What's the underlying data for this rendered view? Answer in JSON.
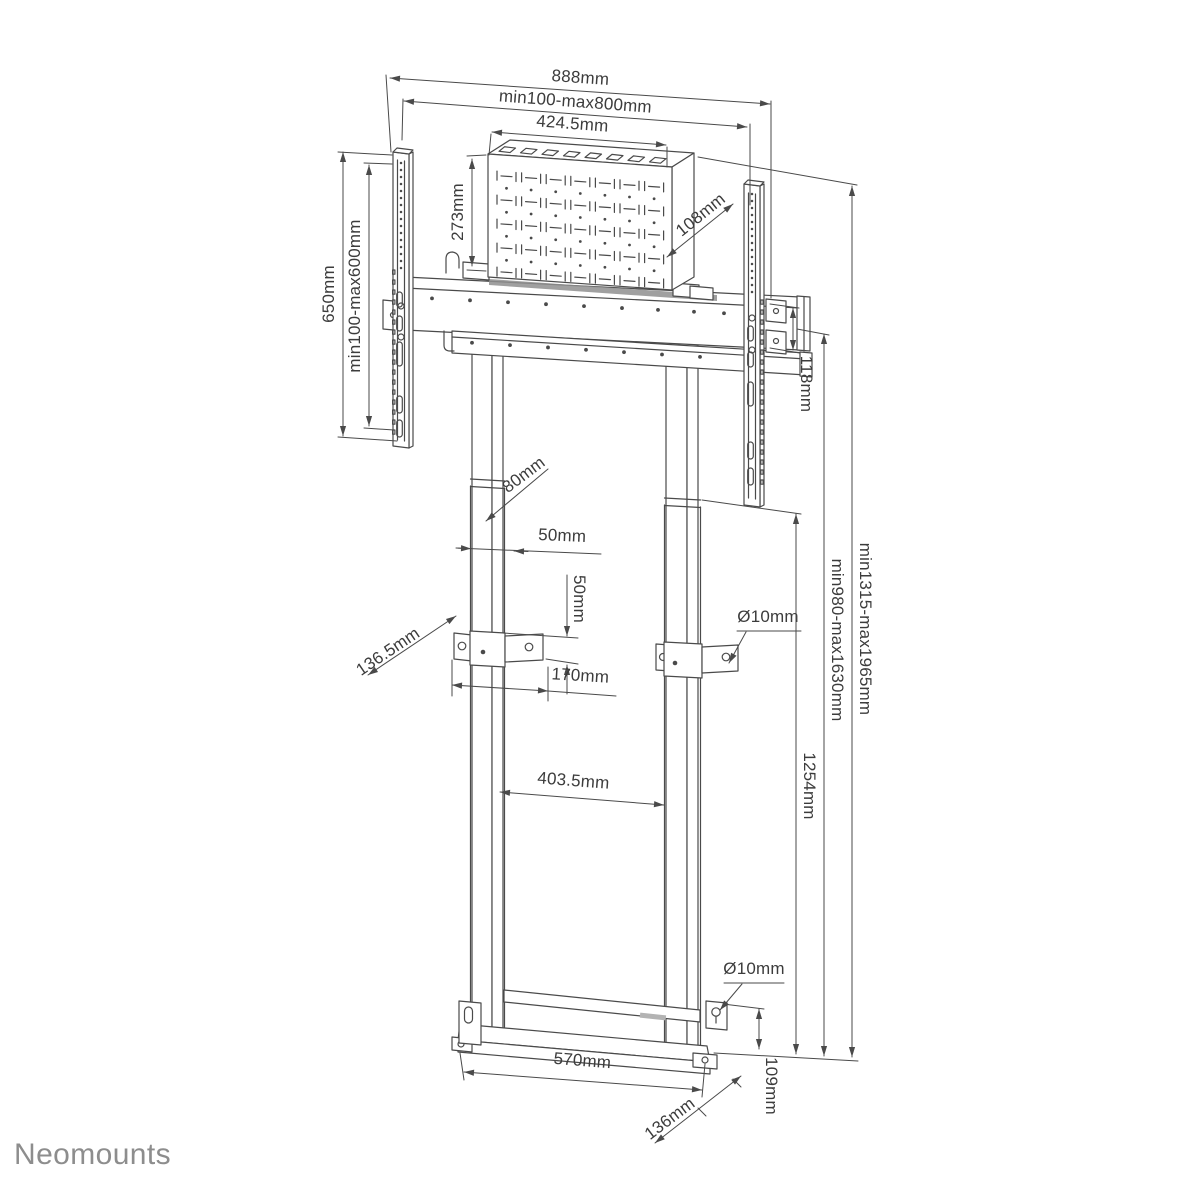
{
  "brand": {
    "logo_text": "Neomounts"
  },
  "colors": {
    "line": "#4a4a4a",
    "label_text": "#3c3c3c",
    "logo_gray": "#8d8d8d",
    "background": "#ffffff"
  },
  "labels": {
    "width_overall": "888mm",
    "width_vesa_range": "min100-max800mm",
    "box_width": "424.5mm",
    "box_height": "273mm",
    "box_depth": "108mm",
    "rail_height": "650mm",
    "vesa_height_range": "min100-max600mm",
    "beam_height": "118mm",
    "column_depth": "80mm",
    "column_width": "50mm",
    "bracket_height": "50mm",
    "bracket_depth": "136.5mm",
    "bracket_hole_diameter": "Ø10mm",
    "bracket_hole_spacing": "170mm",
    "inner_clearance": "403.5mm",
    "lift_height": "1254mm",
    "screen_height_range": "min980-max1630mm",
    "total_height_range": "min1315-max1965mm",
    "base_width": "570mm",
    "base_hole_diameter": "Ø10mm",
    "base_hole_offset": "109mm",
    "base_depth": "136mm"
  }
}
